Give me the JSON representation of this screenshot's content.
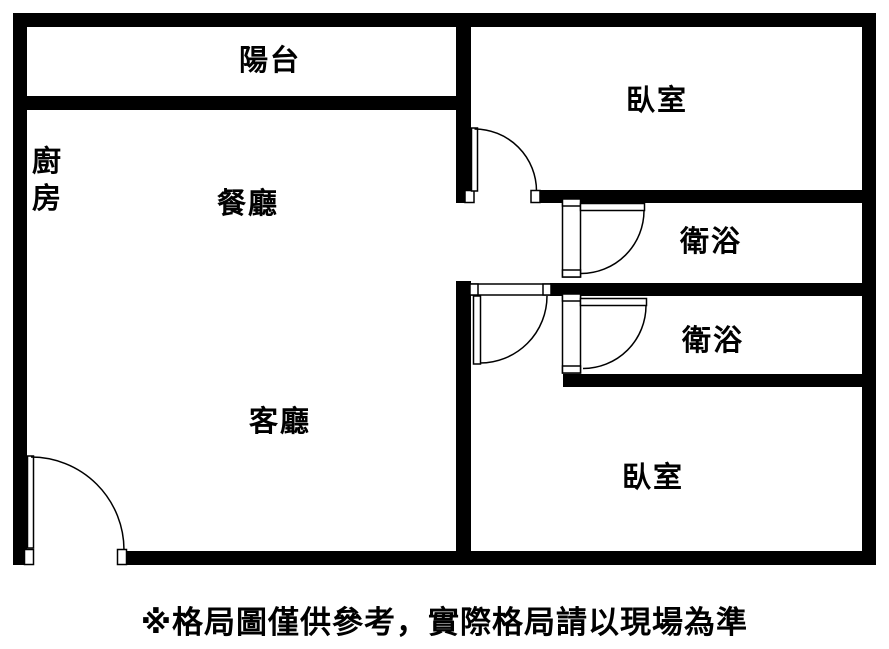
{
  "plan": {
    "background_color": "#ffffff",
    "wall_color": "#000000",
    "text_color": "#000000",
    "rooms": {
      "balcony": {
        "label": "陽台"
      },
      "kitchen": {
        "label": "廚房"
      },
      "dining": {
        "label": "餐廳"
      },
      "living": {
        "label": "客廳"
      },
      "bedroom_top": {
        "label": "臥室"
      },
      "bathroom_top": {
        "label": "衛浴"
      },
      "bathroom_bottom": {
        "label": "衛浴"
      },
      "bedroom_bottom": {
        "label": "臥室"
      }
    }
  },
  "caption": {
    "text": "※格局圖僅供參考，實際格局請以現場為準"
  }
}
